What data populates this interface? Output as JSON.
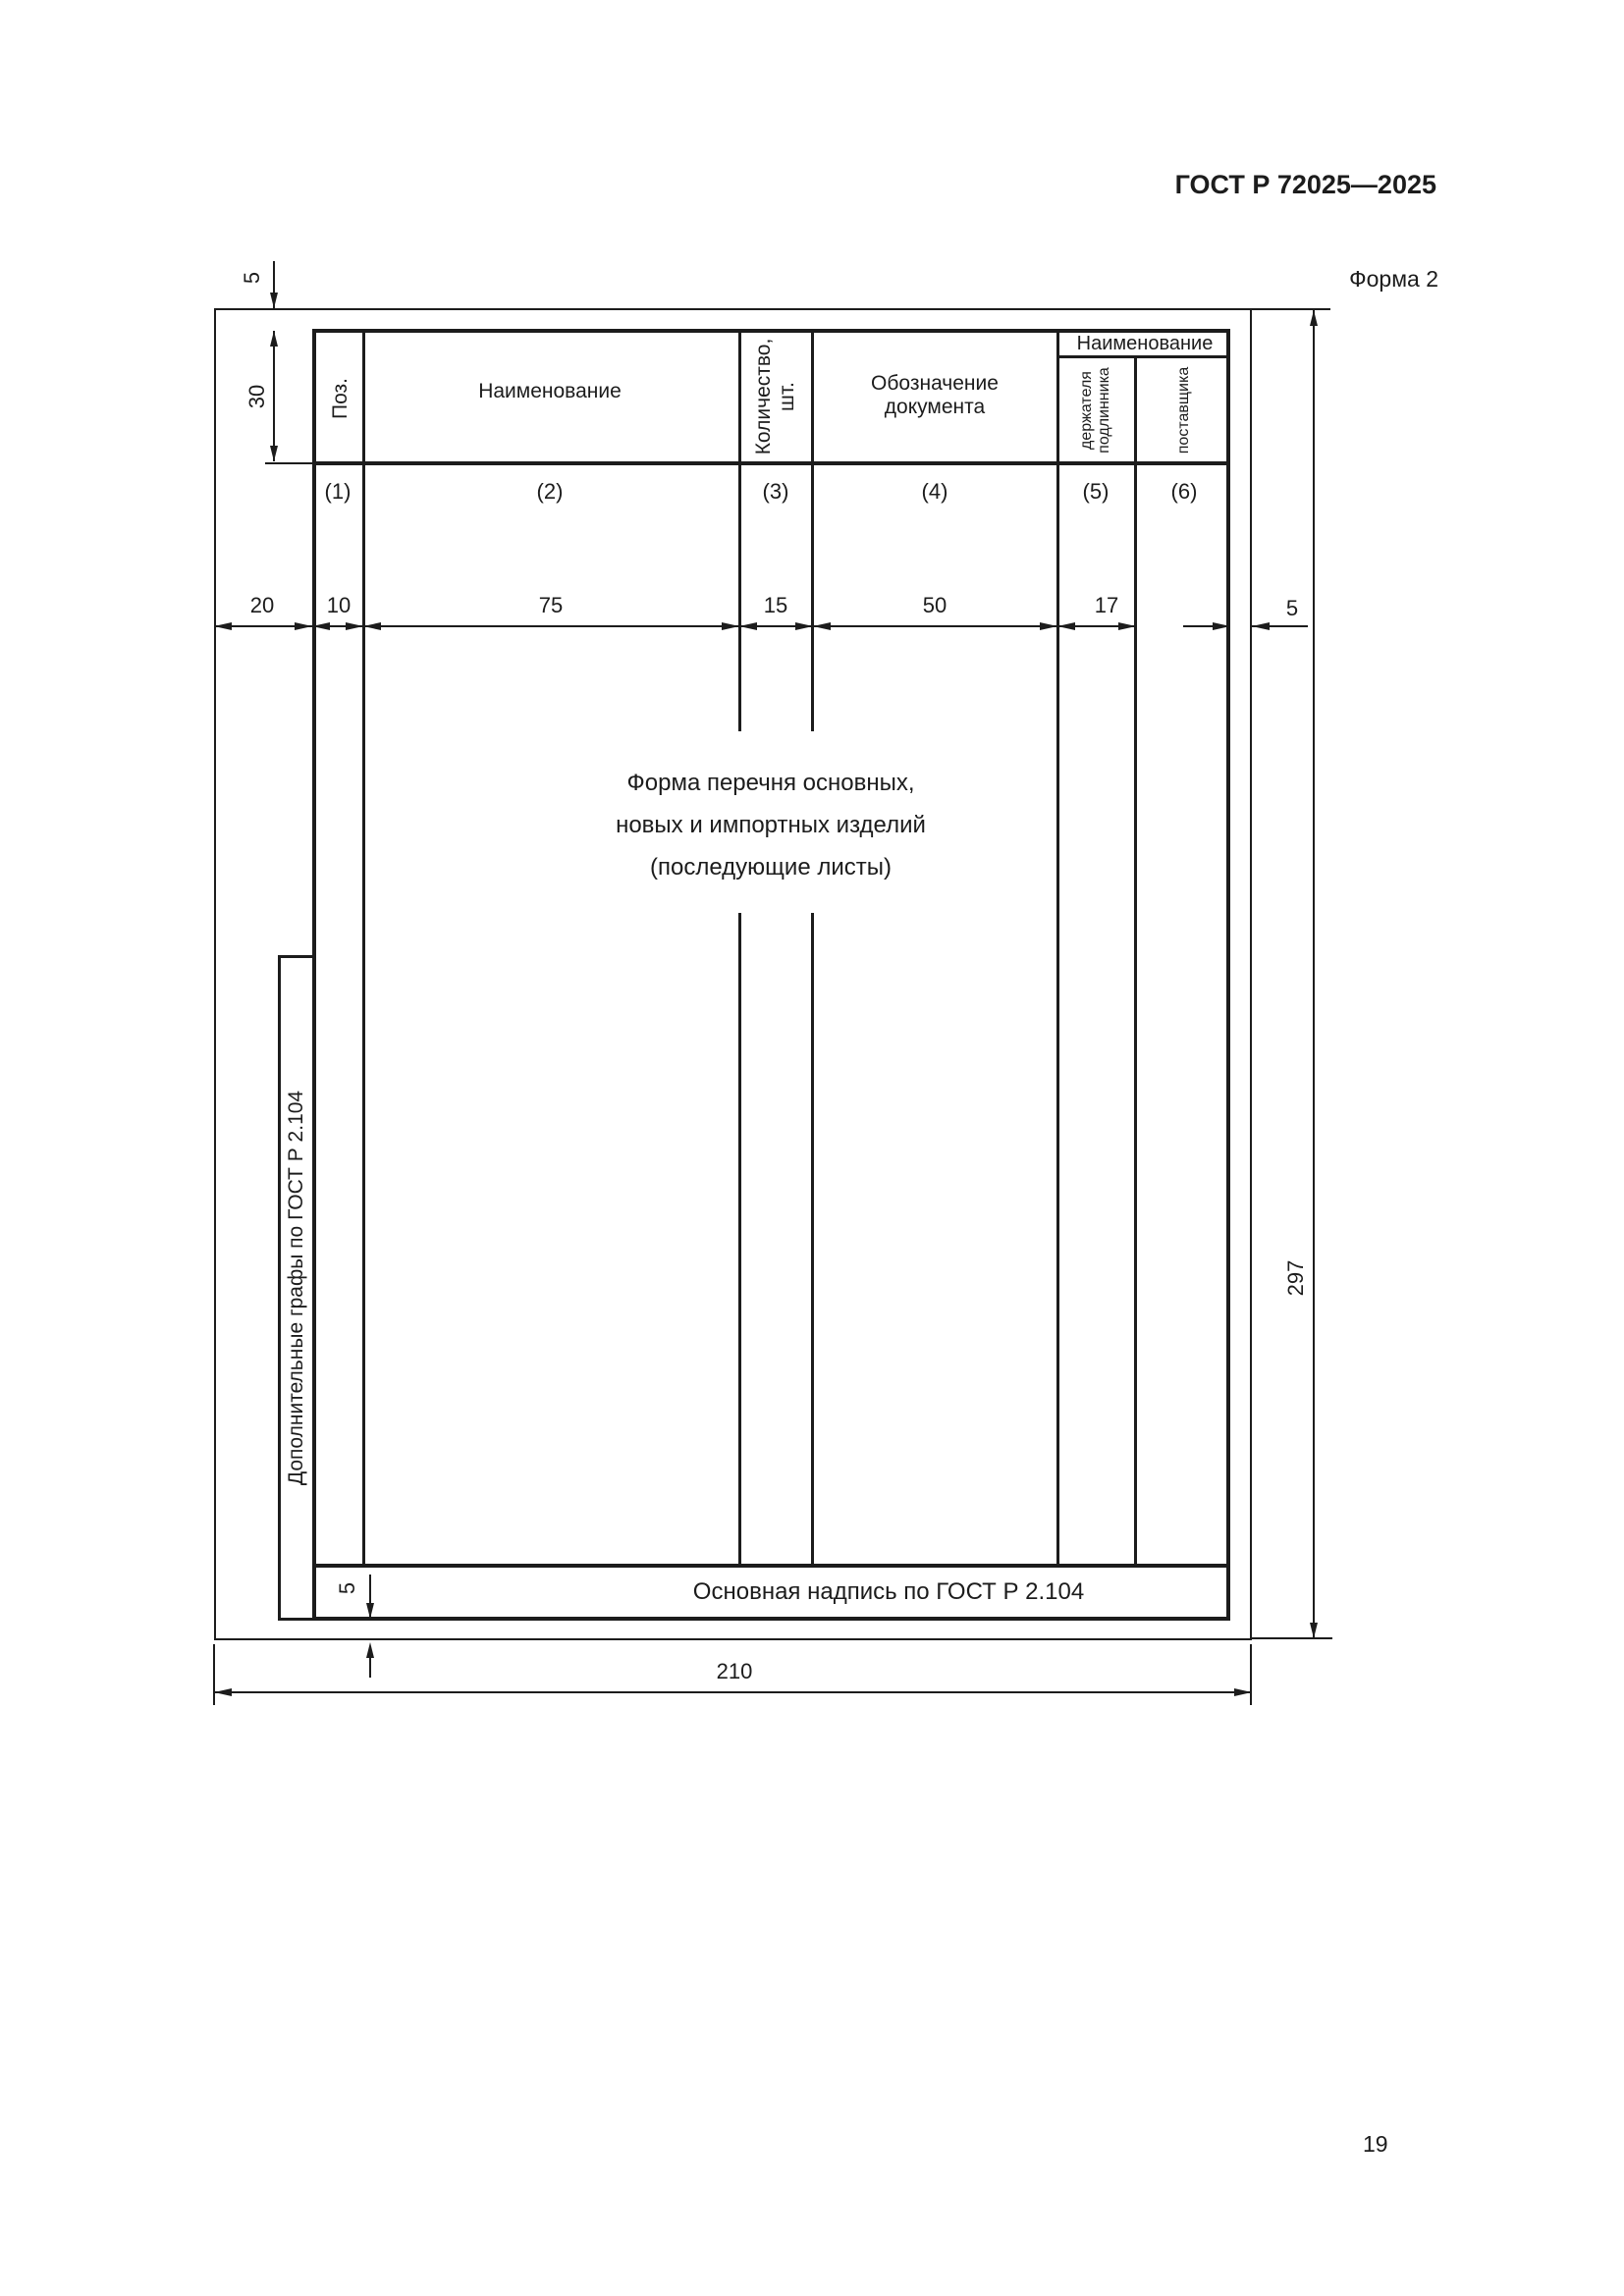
{
  "header": {
    "standard": "ГОСТ Р 72025—2025",
    "form_label": "Форма 2"
  },
  "footer": {
    "page_number": "19"
  },
  "table": {
    "poz": "Поз.",
    "name": "Наименование",
    "qty_line1": "Количество,",
    "qty_line2": "шт.",
    "doc_line1": "Обозначение",
    "doc_line2": "документа",
    "group_name": "Наименование",
    "holder_line1": "держателя",
    "holder_line2": "подлинника",
    "supplier": "поставщика",
    "col_numbers": [
      "(1)",
      "(2)",
      "(3)",
      "(4)",
      "(5)",
      "(6)"
    ]
  },
  "dimensions": {
    "top_margin": "5",
    "header_height": "30",
    "extra_width": "20",
    "poz_width": "10",
    "name_width": "75",
    "qty_width": "15",
    "doc_width": "50",
    "holder_width": "17",
    "right_margin": "5",
    "height": "297",
    "width": "210",
    "titleblock_margin": "5"
  },
  "annotations": {
    "center_line1": "Форма перечня основных,",
    "center_line2": "новых и импортных изделий",
    "center_line3": "(последующие листы)",
    "title_block": "Основная надпись по ГОСТ Р 2.104",
    "format": "Формат А4",
    "extra_columns": "Дополнительные графы по ГОСТ Р 2.104"
  }
}
